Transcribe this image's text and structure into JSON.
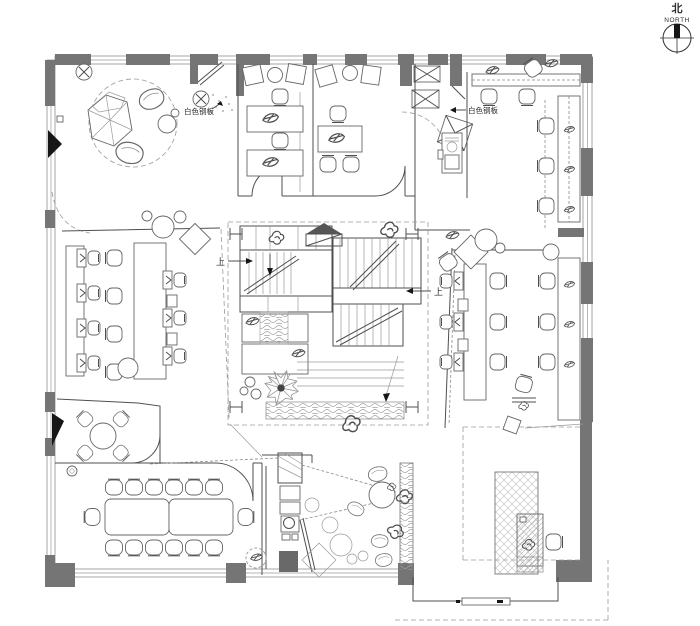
{
  "compass": {
    "label_zh": "北",
    "label_en": "NORTH"
  },
  "annotations": {
    "steel_plate_left": "白色钢板",
    "steel_plate_right": "白色钢板",
    "stair_up_left": "上",
    "stair_up_right": "上"
  },
  "colors": {
    "background": "#ffffff",
    "wall": "#757575",
    "line": "#4f4f4f",
    "light_line": "#9a9a9a",
    "black": "#161616"
  }
}
